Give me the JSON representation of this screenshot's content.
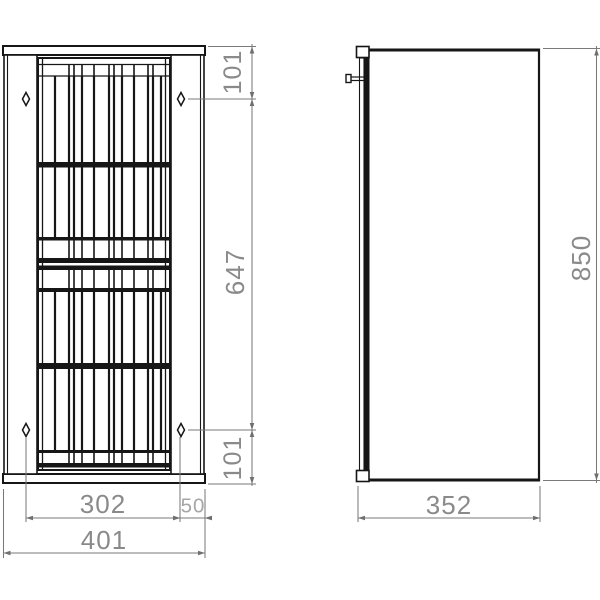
{
  "dimensions": {
    "front": {
      "top_to_hole": "101",
      "hole_to_hole_vertical": "647",
      "bottom_to_hole": "101",
      "hole_to_hole_horizontal": "302",
      "hole_to_side_edge": "50",
      "overall_width": "401"
    },
    "side": {
      "overall_height": "850",
      "overall_depth": "352"
    }
  }
}
